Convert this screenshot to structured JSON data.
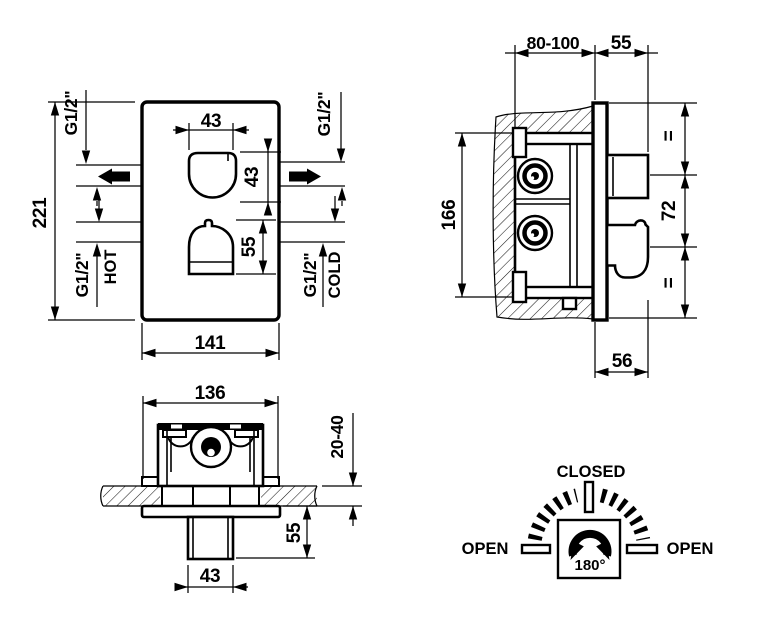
{
  "front_view": {
    "plate_height": "221",
    "plate_width": "141",
    "knob_width": "43",
    "knob_height": "43",
    "lower_knob_height": "55",
    "outlet_left_thread": "G1/2\"",
    "outlet_right_thread": "G1/2\"",
    "inlet_hot_thread": "G1/2\"",
    "inlet_hot_label": "HOT",
    "inlet_cold_thread": "G1/2\"",
    "inlet_cold_label": "COLD"
  },
  "side_view": {
    "recess_depth": "80-100",
    "knob_protrusion": "55",
    "body_height": "166",
    "handle_spacing": "72",
    "equal_top": "=",
    "equal_bottom": "=",
    "trim_depth": "56"
  },
  "installation_view": {
    "box_width": "136",
    "finish_depth_range": "20-40",
    "knob_protrusion": "55",
    "knob_width": "43"
  },
  "rotation_diagram": {
    "closed_label": "CLOSED",
    "open_left_label": "OPEN",
    "open_right_label": "OPEN",
    "angle_label": "180°"
  }
}
